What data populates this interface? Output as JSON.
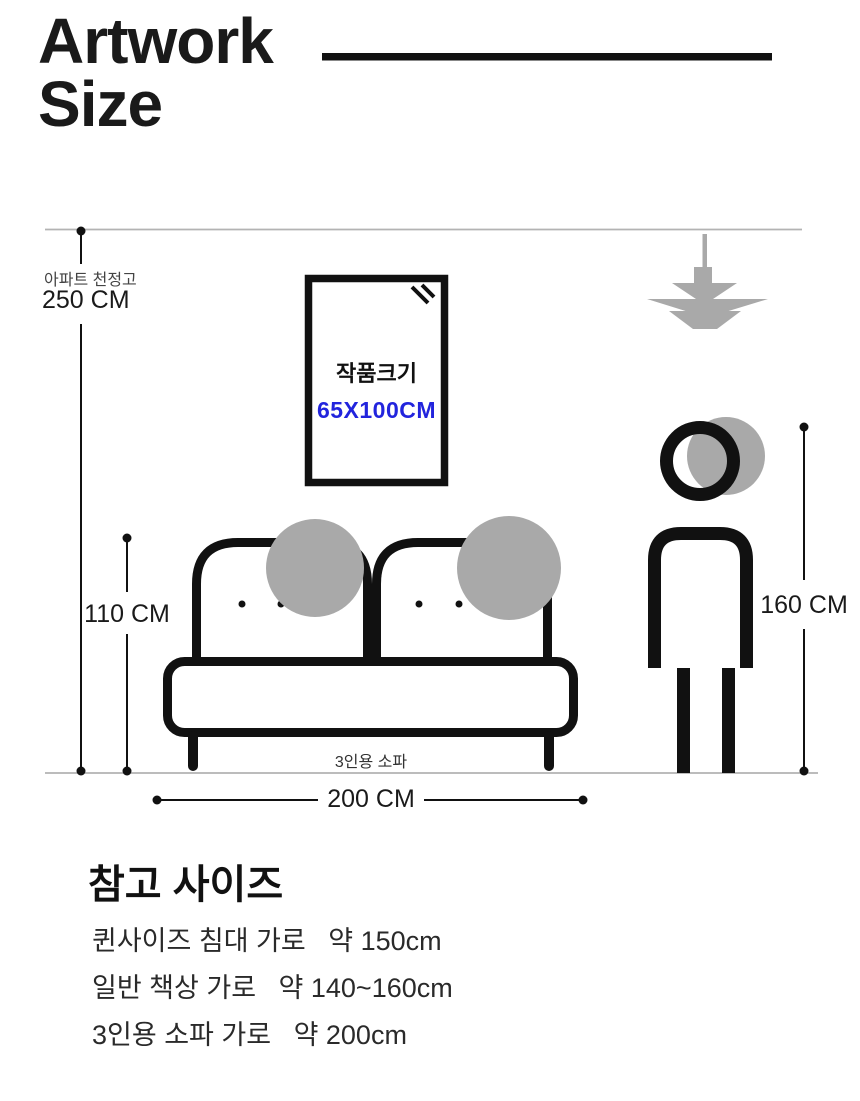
{
  "header": {
    "title_line1": "Artwork",
    "title_line2": "Size"
  },
  "diagram": {
    "ceiling": {
      "label": "아파트 천정고",
      "value": "250 CM"
    },
    "artwork": {
      "label": "작품크기",
      "size": "65X100CM"
    },
    "sofa": {
      "height": "110 CM",
      "width": "200 CM",
      "label": "3인용 소파"
    },
    "person": {
      "height": "160 CM"
    }
  },
  "reference": {
    "heading": "참고 사이즈",
    "items": [
      "퀸사이즈 침대 가로   약 150cm",
      "일반 책상 가로   약 140~160cm",
      "3인용 소파 가로   약 200cm"
    ]
  },
  "colors": {
    "ink": "#111111",
    "accent_blue": "#2224dd",
    "icon_gray": "#a9a9a9",
    "guide_line_gray": "#b3b3b3"
  }
}
